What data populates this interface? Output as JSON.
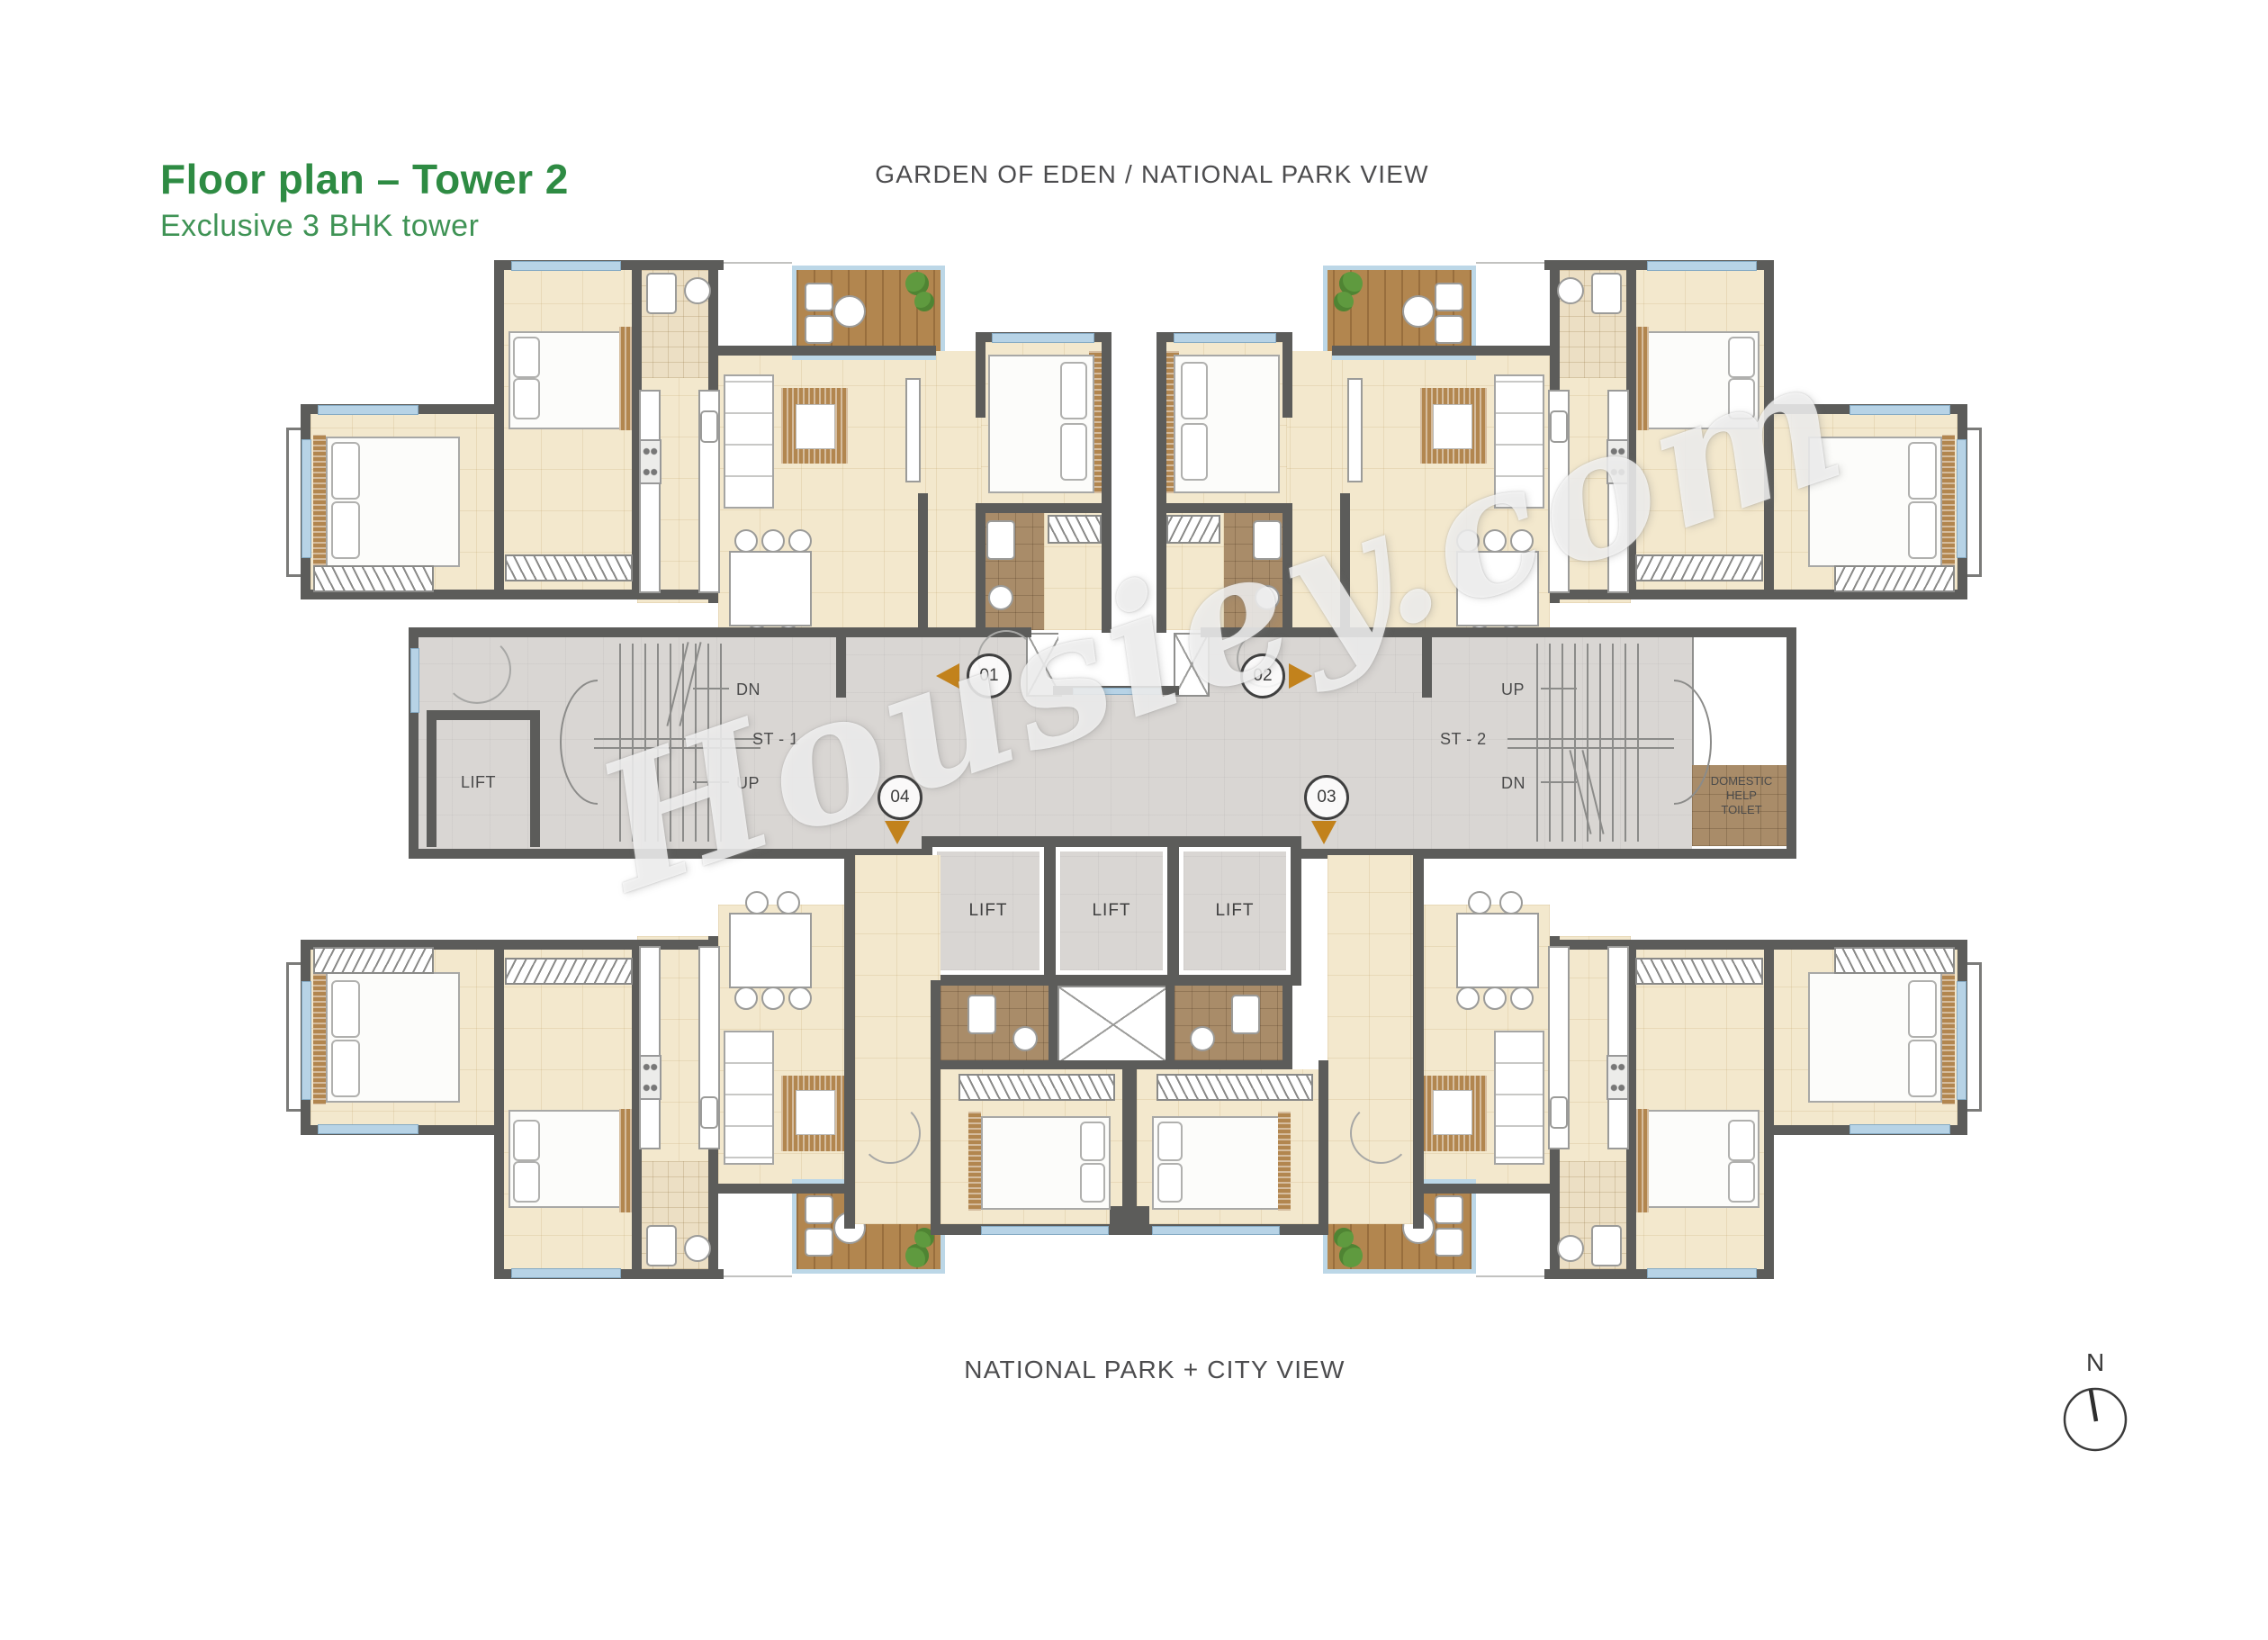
{
  "page": {
    "title": "Floor plan – Tower 2",
    "subtitle": "Exclusive 3 BHK tower",
    "top_caption": "GARDEN OF EDEN / NATIONAL PARK VIEW",
    "bottom_caption": "NATIONAL PARK + CITY VIEW",
    "watermark": "Housiey.com"
  },
  "colors": {
    "accent_green": "#2e8b43",
    "caption_gray": "#4c4c4e",
    "wall": "#5c5c5a",
    "core_floor": "#d9d6d3",
    "apartment_floor": "#f3e8cd",
    "bathroom_tile": "#a98c69",
    "deck_wood": "#b2864f",
    "window_glass": "#b7d3e6",
    "marker_orange": "#c2821c"
  },
  "core": {
    "lift": "LIFT",
    "st1": "ST - 1",
    "st2": "ST - 2",
    "dn": "DN",
    "up": "UP",
    "dht": [
      "DOMESTIC",
      "HELP",
      "TOILET"
    ]
  },
  "units": [
    {
      "label": "01"
    },
    {
      "label": "02"
    },
    {
      "label": "03"
    },
    {
      "label": "04"
    }
  ],
  "compass": {
    "north": "N"
  }
}
